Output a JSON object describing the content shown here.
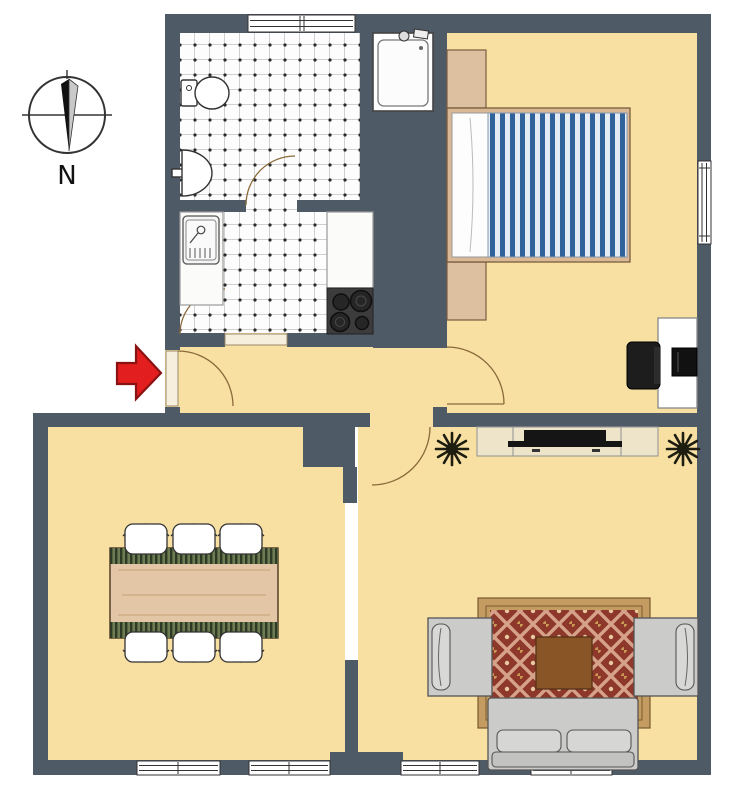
{
  "compass": {
    "label": "N"
  },
  "palette": {
    "wall": "#4e5a66",
    "floor": "#f8dfa2",
    "tile-bg": "#fdfdfd",
    "tile-line": "#c9c9c9",
    "tile-dot": "#2a2a2a",
    "outline": "#333333",
    "arrow-red": "#e31e1e",
    "arrow-red-dark": "#8a1212",
    "wood-light": "#e3c6a5",
    "wood-mid": "#d9b896",
    "wood-dark": "#8a5526",
    "furn-tan": "#dcc0a0",
    "duvet-blue": "#31639b",
    "duvet-light": "#e4edf6",
    "rug-field": "#8e382b",
    "rug-lattice": "#d6a289",
    "rug-border": "#c49c62",
    "sofa-gray": "#cbcbc9",
    "console-cream": "#eee4c9",
    "dark-appliance": "#3c3c3c",
    "plant-dark": "#1d1d10",
    "runner-dark": "#2f3a26",
    "runner-light": "#6d7c52"
  },
  "rooms": {
    "bathroom": {
      "items": [
        "toilet",
        "washbasin",
        "shower",
        "door",
        "window",
        "tiled-floor"
      ]
    },
    "kitchen": {
      "items": [
        "sink-unit",
        "countertop-left",
        "countertop-right",
        "stove-4-burners",
        "door",
        "tiled-floor"
      ]
    },
    "bedroom": {
      "items": [
        "double-bed-striped-duvet",
        "nightstand-top",
        "nightstand-bottom",
        "desk",
        "office-chair",
        "monitor",
        "window",
        "door"
      ]
    },
    "hallway": {
      "items": [
        "entrance-door",
        "entrance-arrow"
      ]
    },
    "living_room": {
      "items": [
        "tv-console",
        "tv",
        "plant-left",
        "plant-right",
        "rug",
        "coffee-table",
        "armchair-left",
        "armchair-right",
        "sofa",
        "windows",
        "door"
      ]
    },
    "dining_room": {
      "items": [
        "dining-table",
        "table-runners",
        "chairs-x6",
        "windows"
      ]
    }
  }
}
